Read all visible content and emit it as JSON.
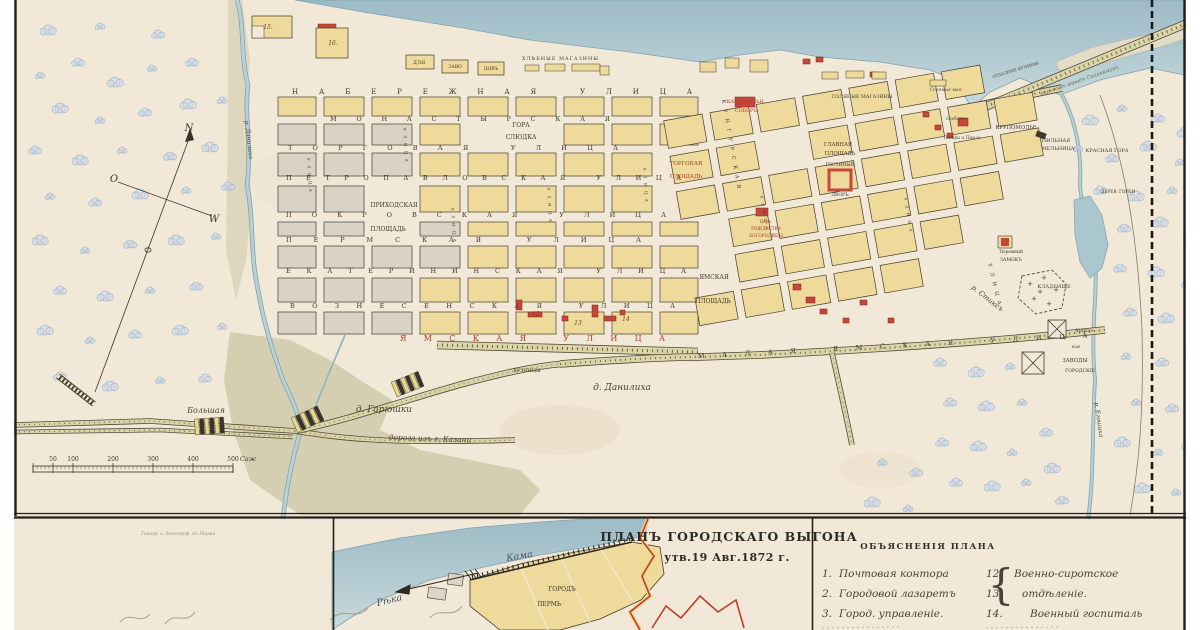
{
  "inset_title": {
    "line1": "ПЛАНЪ ГОРОДСКАГО ВЫГОНА",
    "line2": "утв.19 Авг.1872 г."
  },
  "legend": {
    "heading": "ОБЪЯСНЕНІЯ ПЛАНА",
    "rows": [
      {
        "left_num": "1.",
        "left_text": "Почтовая контора",
        "right_num": "12.",
        "right_text": "Военно-сиротское"
      },
      {
        "left_num": "2.",
        "left_text": "Городовой лазаретъ",
        "right_num": "13.",
        "right_text": "отдѣленіе."
      },
      {
        "left_num": "3.",
        "left_text": "Город. управленіе.",
        "right_num": "14.",
        "right_text": "Военный госпиталь"
      }
    ]
  },
  "scalebar": {
    "ticks": [
      "50",
      "100",
      "200",
      "300",
      "400",
      "500"
    ],
    "unit": "Саж"
  },
  "compass": {
    "n": "N",
    "o": "O",
    "w": "W"
  },
  "colors": {
    "paper": "#f1e8d7",
    "water": "#aac6cf",
    "block_yellow": "#eeda9b",
    "block_gray": "#d9d3c6",
    "building_red": "#c5473a",
    "meadow": "#c8c4a0",
    "accent_red_text": "#b03a28"
  },
  "labels": [
    {
      "n": "street-naberezhnaya",
      "t": "НАБЕРЕЖНАЯ УЛИЦА",
      "x": 292,
      "y": 94,
      "s": 7,
      "tl": 400,
      "c": "st"
    },
    {
      "n": "street-monastyrskaya",
      "t": "МОНАСТЫРСКАЯ",
      "x": 330,
      "y": 121,
      "s": 6.5,
      "tl": 280,
      "c": "st"
    },
    {
      "n": "street-torgovaya",
      "t": "ТОРГОВАЯ УЛИЦА",
      "x": 288,
      "y": 150,
      "s": 6.5,
      "tl": 330,
      "c": "st"
    },
    {
      "n": "street-petropavlovskaya",
      "t": "ПЕТРОПАВЛОВСКАЯ УЛИЦА",
      "x": 286,
      "y": 180,
      "s": 6.5,
      "tl": 395,
      "c": "st"
    },
    {
      "n": "street-pokrovskaya",
      "t": "ПОКРОВСКАЯ УЛИЦА",
      "x": 286,
      "y": 217,
      "s": 6.5,
      "tl": 380,
      "c": "st"
    },
    {
      "n": "street-permskaya",
      "t": "ПЕРМСКАЯ УЛИЦА",
      "x": 286,
      "y": 242,
      "s": 6.5,
      "tl": 355,
      "c": "st"
    },
    {
      "n": "street-ekaterininskaya",
      "t": "ЕКАТЕРИНИНСКАЯ УЛИЦА",
      "x": 286,
      "y": 273,
      "s": 6.5,
      "tl": 400,
      "c": "st"
    },
    {
      "n": "street-voznesenskaya",
      "t": "ВОЗНЕСЕНСКАЯ УЛИЦА",
      "x": 290,
      "y": 308,
      "s": 6.5,
      "tl": 385,
      "c": "st"
    },
    {
      "n": "street-yamskaya",
      "t": "ЯМСКАЯ УЛИЦА",
      "x": 400,
      "y": 341,
      "s": 8,
      "tl": 265,
      "c": "sr"
    },
    {
      "n": "street-malaya-yamskaya",
      "t": "МАЛАЯ ЯМСКАЯ УЛИЦА",
      "x": 698,
      "y": 358,
      "s": 6.5,
      "tl": 390,
      "r": -3,
      "c": "st"
    },
    {
      "n": "street-kungurskaya",
      "t": "КУНГУРСКАЯ",
      "x": 722,
      "y": 100,
      "s": 5,
      "tl": 90,
      "r": 80,
      "c": "st"
    },
    {
      "n": "street-vertical-1",
      "t": "УЛИЦА",
      "x": 988,
      "y": 264,
      "s": 5,
      "tl": 42,
      "r": 76,
      "c": "st"
    },
    {
      "n": "street-vertical-2",
      "t": "УЛИЦА",
      "x": 307,
      "y": 158,
      "s": 4,
      "tl": 34,
      "r": 86,
      "c": "st"
    },
    {
      "n": "street-vertical-3",
      "t": "УЛИЦА",
      "x": 403,
      "y": 128,
      "s": 4,
      "tl": 34,
      "r": 86,
      "c": "st"
    },
    {
      "n": "street-vertical-4",
      "t": "УЛИЦА",
      "x": 451,
      "y": 208,
      "s": 4,
      "tl": 34,
      "r": 86,
      "c": "st"
    },
    {
      "n": "street-vertical-5",
      "t": "УЛИЦА",
      "x": 547,
      "y": 188,
      "s": 4,
      "tl": 34,
      "r": 86,
      "c": "st"
    },
    {
      "n": "street-vertical-6",
      "t": "УЛИЦА",
      "x": 643,
      "y": 168,
      "s": 4,
      "tl": 34,
      "r": 86,
      "c": "st"
    },
    {
      "n": "street-vertical-7",
      "t": "УЛИЦА",
      "x": 760,
      "y": 196,
      "s": 4,
      "tl": 34,
      "r": 80,
      "c": "st"
    },
    {
      "n": "street-vertical-8",
      "t": "УЛИЦА",
      "x": 904,
      "y": 198,
      "s": 4,
      "tl": 34,
      "r": 80,
      "c": "st"
    },
    {
      "n": "label-gora-sludka-1",
      "t": "ГОРА",
      "x": 521,
      "y": 127,
      "s": 6,
      "a": "m",
      "c": "pl"
    },
    {
      "n": "label-gora-sludka-2",
      "t": "СЛЮДКА",
      "x": 521,
      "y": 139,
      "s": 6,
      "a": "m",
      "c": "pl"
    },
    {
      "n": "label-torgovaya-pl-1",
      "t": "ТОРГОВАЯ",
      "x": 686,
      "y": 165,
      "s": 5.5,
      "a": "m",
      "c": "pr"
    },
    {
      "n": "label-torgovaya-pl-2",
      "t": "ПЛОЩАДЬ",
      "x": 686,
      "y": 178,
      "s": 5.5,
      "a": "m",
      "c": "pr"
    },
    {
      "n": "label-prihodskaya-pl-1",
      "t": "ПРИХОДСКАЯ",
      "x": 394,
      "y": 207,
      "s": 6,
      "a": "m",
      "c": "pl"
    },
    {
      "n": "label-prihodskaya-pl-2",
      "t": "ПЛОЩАДЬ",
      "x": 388,
      "y": 231,
      "s": 6,
      "a": "m",
      "c": "pl"
    },
    {
      "n": "label-yamskaya-pl-1",
      "t": "ЯМСКАЯ",
      "x": 714,
      "y": 279,
      "s": 6,
      "a": "m",
      "c": "pl"
    },
    {
      "n": "label-yamskaya-pl-2",
      "t": "ПЛОЩАДЬ",
      "x": 713,
      "y": 303,
      "s": 6,
      "a": "m",
      "c": "pl"
    },
    {
      "n": "label-kafedralny-1",
      "t": "КАФЕДРАЛЬН.",
      "x": 746,
      "y": 103,
      "s": 4.8,
      "a": "m",
      "c": "pr"
    },
    {
      "n": "label-kafedralny-2",
      "t": "СОБОРЪ",
      "x": 746,
      "y": 112,
      "s": 4.8,
      "a": "m",
      "c": "pr"
    },
    {
      "n": "label-solyanye-magaziny",
      "t": "СОЛЯНЫЕ МАГАЗИНЫ",
      "x": 862,
      "y": 98,
      "s": 4.8,
      "a": "m",
      "c": "pl"
    },
    {
      "n": "label-solyanye-mag",
      "t": "Соляные маг.",
      "x": 946,
      "y": 91,
      "s": 4.5,
      "a": "m",
      "c": "cu"
    },
    {
      "n": "label-glavnaya-pl-1",
      "t": "ГЛАВНАЯ",
      "x": 838,
      "y": 146,
      "s": 5.2,
      "a": "m",
      "c": "pl"
    },
    {
      "n": "label-glavnaya-pl-2",
      "t": "ПЛОЩАДЬ",
      "x": 840,
      "y": 155,
      "s": 5.2,
      "a": "m",
      "c": "pl"
    },
    {
      "n": "label-gostiny-1",
      "t": "ГОСТИНЫЙ",
      "x": 840,
      "y": 166,
      "s": 4.5,
      "a": "m",
      "c": "pl"
    },
    {
      "n": "label-gostiny-2",
      "t": "ДВОРЪ",
      "x": 840,
      "y": 196,
      "s": 4.5,
      "a": "m",
      "c": "pl"
    },
    {
      "n": "label-sobor-petra",
      "t": "Соборъ",
      "x": 956,
      "y": 120,
      "s": 5,
      "a": "m",
      "c": "cu"
    },
    {
      "n": "label-petra-pavla",
      "t": "Петра и Павла",
      "x": 962,
      "y": 139,
      "s": 4.5,
      "a": "m",
      "c": "cu"
    },
    {
      "n": "label-tserkov-1",
      "t": "Церк.",
      "x": 766,
      "y": 223,
      "s": 4.2,
      "a": "m",
      "c": "pr"
    },
    {
      "n": "label-tserkov-2",
      "t": "РОЖДЕСТВА",
      "x": 766,
      "y": 230,
      "s": 4.2,
      "a": "m",
      "c": "pr"
    },
    {
      "n": "label-tserkov-3",
      "t": "БОГОРОДИЦЫ",
      "x": 766,
      "y": 237,
      "s": 4.2,
      "a": "m",
      "c": "pr"
    },
    {
      "n": "label-krupomolye",
      "t": "КРУПОМОЛЬЕ",
      "x": 1016,
      "y": 129,
      "s": 5.2,
      "a": "m",
      "c": "pl"
    },
    {
      "n": "label-pilnaya-1",
      "t": "ПИЛЬНАЯ",
      "x": 1056,
      "y": 142,
      "s": 5,
      "a": "m",
      "c": "pl"
    },
    {
      "n": "label-pilnaya-2",
      "t": "МЕЛЬНИЦА",
      "x": 1058,
      "y": 150,
      "s": 5,
      "a": "m",
      "c": "pl"
    },
    {
      "n": "label-krasnaya-gora",
      "t": "КРАСНАЯ ГОРА",
      "x": 1107,
      "y": 152,
      "s": 5,
      "a": "m",
      "c": "pl"
    },
    {
      "n": "label-derev-gorki",
      "t": "ДЕРЕВ. ГОРКИ",
      "x": 1118,
      "y": 193,
      "s": 4.2,
      "a": "m",
      "c": "pl"
    },
    {
      "n": "label-tyuremny-1",
      "t": "Тюремный",
      "x": 1011,
      "y": 253,
      "s": 4.2,
      "a": "m",
      "c": "pl"
    },
    {
      "n": "label-tyuremny-2",
      "t": "ЗАМОКЪ",
      "x": 1011,
      "y": 261,
      "s": 4.6,
      "a": "m",
      "c": "pl"
    },
    {
      "n": "label-kladbishche",
      "t": "КЛАДБИЩЕ",
      "x": 1054,
      "y": 288,
      "s": 5,
      "a": "m",
      "c": "pl"
    },
    {
      "n": "label-kirpichnye-1",
      "t": "Кирпич-",
      "x": 1085,
      "y": 332,
      "s": 4.4,
      "a": "m",
      "c": "cu"
    },
    {
      "n": "label-kirpichnye-2",
      "t": "ные",
      "x": 1076,
      "y": 348,
      "s": 4.4,
      "a": "m",
      "c": "cu"
    },
    {
      "n": "label-zavody-1",
      "t": "ЗАВОДЫ",
      "x": 1075,
      "y": 362,
      "s": 5.4,
      "a": "m",
      "c": "pl"
    },
    {
      "n": "label-zavody-2",
      "t": "ГОРОДСКІЕ",
      "x": 1080,
      "y": 372,
      "s": 4.6,
      "a": "m",
      "c": "pl"
    },
    {
      "n": "label-kuznitsy",
      "t": "КУЗНИЦЫ",
      "x": 527,
      "y": 372,
      "s": 4.8,
      "a": "m",
      "c": "pl"
    },
    {
      "n": "label-hlebnye-magaziny",
      "t": "ХЛѢБНЫЕ МАГАЗИНЫ",
      "x": 560,
      "y": 60,
      "s": 4.8,
      "a": "m",
      "tl": 76,
      "c": "pl"
    },
    {
      "n": "label-dlya",
      "t": "ДЛЯ",
      "x": 419,
      "y": 64,
      "s": 5,
      "a": "m",
      "c": "pl"
    },
    {
      "n": "label-zavo",
      "t": "ЗАВО",
      "x": 455,
      "y": 68,
      "s": 4.6,
      "a": "m",
      "c": "pl"
    },
    {
      "n": "label-dov",
      "t": "ДОВЪ",
      "x": 491,
      "y": 70,
      "s": 4.6,
      "a": "m",
      "c": "pl"
    },
    {
      "n": "number-15",
      "t": "15.",
      "x": 268,
      "y": 29,
      "s": 6,
      "a": "m",
      "c": "cn"
    },
    {
      "n": "number-16",
      "t": "16.",
      "x": 333,
      "y": 45,
      "s": 6,
      "a": "m",
      "c": "cn"
    },
    {
      "n": "number-12",
      "t": "12",
      "x": 536,
      "y": 316,
      "s": 6,
      "a": "m",
      "c": "cn"
    },
    {
      "n": "number-13",
      "t": "13",
      "x": 578,
      "y": 325,
      "s": 6,
      "a": "m",
      "c": "cn"
    },
    {
      "n": "number-14",
      "t": "14",
      "x": 626,
      "y": 321,
      "s": 6,
      "a": "m",
      "c": "cn"
    },
    {
      "n": "label-r-danilikha",
      "t": "р. Данилиха",
      "x": 247,
      "y": 140,
      "s": 6,
      "r": 83,
      "a": "m",
      "c": "cu"
    },
    {
      "n": "label-d-danilikha",
      "t": "д. Данилиха",
      "x": 622,
      "y": 390,
      "s": 9,
      "a": "m",
      "c": "cu"
    },
    {
      "n": "label-d-garyushki",
      "t": "д. Гарюшки",
      "x": 384,
      "y": 412,
      "s": 9,
      "a": "m",
      "c": "cu"
    },
    {
      "n": "label-bolshaya",
      "t": "Большая",
      "x": 206,
      "y": 413,
      "s": 8,
      "a": "m",
      "c": "cu"
    },
    {
      "n": "label-doroga-kazani",
      "t": "дорога изъ г. Казани",
      "x": 430,
      "y": 441,
      "s": 7.5,
      "r": 2,
      "a": "m",
      "c": "cu"
    },
    {
      "n": "label-r-stiks",
      "t": "р. Стиксъ",
      "x": 986,
      "y": 300,
      "s": 7,
      "r": 38,
      "a": "m",
      "c": "cu"
    },
    {
      "n": "label-r-egoshikha",
      "t": "р. Егошиха",
      "x": 1097,
      "y": 420,
      "s": 6,
      "r": 82,
      "a": "m",
      "c": "cu"
    },
    {
      "n": "label-doroga-solikamsk",
      "t": "дорога въ городъ Соликамскъ",
      "x": 1080,
      "y": 82,
      "s": 5.2,
      "r": -19,
      "a": "m",
      "c": "cuo"
    },
    {
      "n": "label-otdalenie-kuznitsy",
      "t": "ОТДАЛЕНІЕ КУЗНИЦЫ",
      "x": 1016,
      "y": 71,
      "s": 3.8,
      "r": -17,
      "a": "m",
      "c": "pl"
    },
    {
      "n": "inset-title-line1",
      "t": "ПЛАНЪ ГОРОДСКАГО ВЫГОНА",
      "x": 729,
      "y": 541,
      "s": 12.5,
      "a": "m",
      "c": "ti"
    },
    {
      "n": "inset-title-line2",
      "t": "утв.19 Авг.1872 г.",
      "x": 727,
      "y": 561,
      "s": 11,
      "a": "m",
      "c": "ti2"
    },
    {
      "n": "inset-label-reka",
      "t": "Рѣка",
      "x": 390,
      "y": 603,
      "s": 9.5,
      "r": -14,
      "a": "m",
      "c": "cuw"
    },
    {
      "n": "inset-label-kama",
      "t": "Кама",
      "x": 520,
      "y": 559,
      "s": 9.5,
      "r": -10,
      "a": "m",
      "c": "cuw"
    },
    {
      "n": "inset-label-gorod",
      "t": "ГОРОДЪ",
      "x": 562,
      "y": 591,
      "s": 6,
      "a": "m",
      "c": "pl"
    },
    {
      "n": "inset-label-perm",
      "t": "ПЕРМЬ",
      "x": 549,
      "y": 606,
      "s": 6,
      "a": "m",
      "c": "pl"
    },
    {
      "n": "legend-heading",
      "t": "ОБЪЯСНЕНІЯ ПЛАНА",
      "x": 928,
      "y": 549,
      "s": 8.5,
      "a": "m",
      "c": "hd"
    },
    {
      "n": "printer-mark",
      "t": "Типогр. и Литограф. въ Перми",
      "x": 178,
      "y": 535,
      "s": 4.5,
      "a": "m",
      "c": "cu2"
    },
    {
      "n": "compass-n",
      "t": "N",
      "x": 189,
      "y": 131,
      "s": 10,
      "a": "m",
      "c": "cm"
    },
    {
      "n": "compass-o",
      "t": "O",
      "x": 114,
      "y": 182,
      "s": 10,
      "a": "m",
      "c": "cm"
    },
    {
      "n": "compass-w",
      "t": "W",
      "x": 214,
      "y": 222,
      "s": 10,
      "a": "m",
      "c": "cm"
    }
  ]
}
